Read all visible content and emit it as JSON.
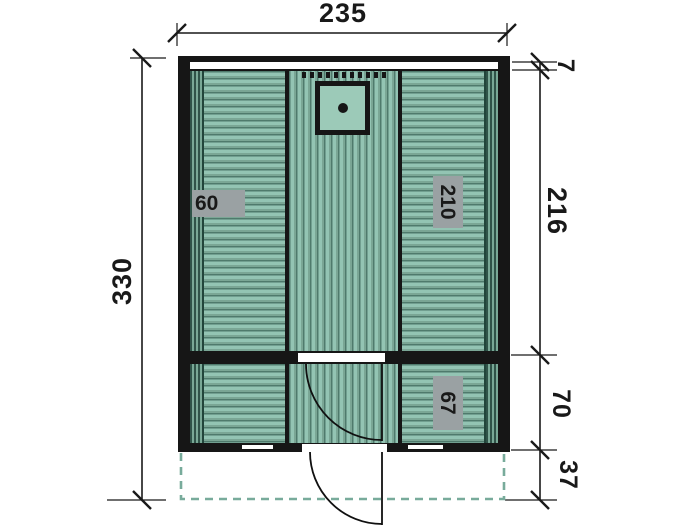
{
  "drawing": {
    "type": "floor-plan",
    "dimensions": {
      "top_width": "235",
      "left_total_depth": "330",
      "right_roof_edge": "7",
      "right_main_room_depth": "216",
      "right_front_room_depth": "70",
      "right_terrace_depth": "37"
    },
    "interior_labels": {
      "left_bench": "60",
      "right_bench": "210",
      "front_bench": "67"
    },
    "colors": {
      "plank_light": "#93c4b3",
      "plank_mid": "#7aa695",
      "plank_dark": "#4f7a6c",
      "stripe_dark": "#2f5348",
      "stripe_green": "#79a896",
      "plain_fill": "#9ccab8",
      "wall_black": "#161616",
      "label_gray": "#9aa1a3",
      "terrace_dash": "#78ab9b",
      "text_color": "#191919"
    }
  }
}
